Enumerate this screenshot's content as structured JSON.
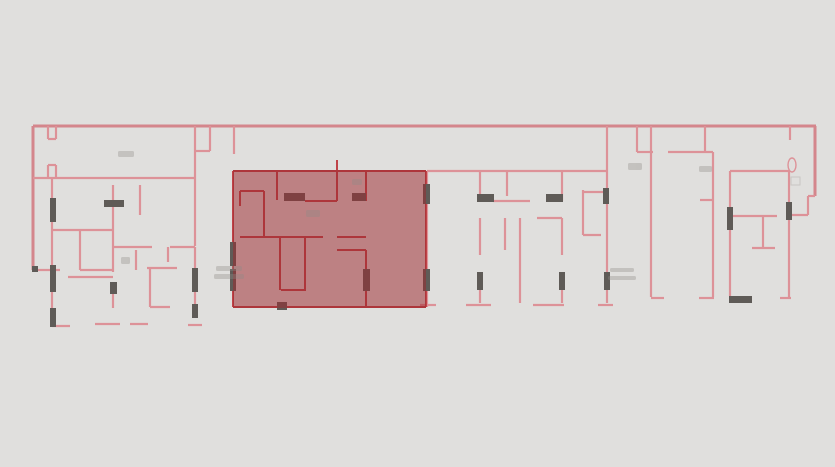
{
  "canvas": {
    "width": 835,
    "height": 467,
    "background": "#e0dfdd"
  },
  "palette": {
    "wall_pink": "#dd9298",
    "wall_pink_dark": "#d4868c",
    "wall_red": "#bf4348",
    "highlight_fill": "#9e2b30",
    "highlight_opacity": 0.52,
    "marker_dark": "#5f5b57",
    "fixture_faint": "#c9c6c2",
    "annotation": "#8f8b87"
  },
  "floorplan": {
    "outer_walls": [
      [
        33,
        126,
        816,
        126
      ],
      [
        815,
        126,
        815,
        196
      ],
      [
        33,
        126,
        33,
        270
      ]
    ],
    "pink_walls": [
      [
        808,
        196,
        815,
        196
      ],
      [
        808,
        196,
        808,
        215
      ],
      [
        789,
        215,
        808,
        215
      ],
      [
        33,
        270,
        60,
        270
      ],
      [
        48,
        126,
        48,
        139
      ],
      [
        56,
        126,
        56,
        139
      ],
      [
        48,
        139,
        56,
        139
      ],
      [
        48,
        165,
        48,
        178
      ],
      [
        56,
        165,
        56,
        178
      ],
      [
        48,
        165,
        56,
        165
      ],
      [
        33,
        178,
        195,
        178
      ],
      [
        195,
        126,
        195,
        246
      ],
      [
        210,
        126,
        210,
        151
      ],
      [
        195,
        151,
        210,
        151
      ],
      [
        234,
        126,
        234,
        154
      ],
      [
        52,
        178,
        52,
        198
      ],
      [
        52,
        222,
        52,
        265
      ],
      [
        52,
        292,
        52,
        308
      ],
      [
        52,
        326,
        70,
        326
      ],
      [
        80,
        230,
        80,
        270
      ],
      [
        52,
        230,
        113,
        230
      ],
      [
        80,
        270,
        113,
        270
      ],
      [
        113,
        185,
        113,
        272
      ],
      [
        113,
        294,
        113,
        308
      ],
      [
        95,
        324,
        120,
        324
      ],
      [
        68,
        277,
        113,
        277
      ],
      [
        140,
        185,
        140,
        215
      ],
      [
        113,
        247,
        152,
        247
      ],
      [
        170,
        247,
        195,
        247
      ],
      [
        168,
        247,
        168,
        262
      ],
      [
        136,
        250,
        136,
        270
      ],
      [
        130,
        324,
        148,
        324
      ],
      [
        147,
        268,
        177,
        268
      ],
      [
        150,
        268,
        150,
        307
      ],
      [
        150,
        307,
        170,
        307
      ],
      [
        195,
        247,
        195,
        268
      ],
      [
        195,
        292,
        195,
        304
      ],
      [
        188,
        325,
        202,
        325
      ],
      [
        427,
        171,
        608,
        171
      ],
      [
        427,
        171,
        427,
        307
      ],
      [
        480,
        171,
        480,
        201
      ],
      [
        493,
        201,
        530,
        201
      ],
      [
        507,
        171,
        507,
        196
      ],
      [
        562,
        171,
        562,
        201
      ],
      [
        480,
        218,
        480,
        255
      ],
      [
        505,
        218,
        505,
        250
      ],
      [
        537,
        218,
        562,
        218
      ],
      [
        562,
        218,
        562,
        255
      ],
      [
        520,
        218,
        520,
        303
      ],
      [
        480,
        290,
        480,
        303
      ],
      [
        466,
        305,
        491,
        305
      ],
      [
        562,
        290,
        562,
        303
      ],
      [
        533,
        305,
        564,
        305
      ],
      [
        583,
        190,
        583,
        235
      ],
      [
        583,
        192,
        606,
        192
      ],
      [
        583,
        235,
        601,
        235
      ],
      [
        607,
        126,
        607,
        272
      ],
      [
        607,
        290,
        607,
        303
      ],
      [
        598,
        305,
        613,
        305
      ],
      [
        420,
        305,
        436,
        305
      ],
      [
        637,
        126,
        637,
        152
      ],
      [
        651,
        126,
        651,
        152
      ],
      [
        637,
        152,
        653,
        152
      ],
      [
        668,
        152,
        713,
        152
      ],
      [
        651,
        152,
        651,
        297
      ],
      [
        651,
        298,
        664,
        298
      ],
      [
        713,
        152,
        713,
        297
      ],
      [
        699,
        298,
        714,
        298
      ],
      [
        700,
        200,
        713,
        200
      ],
      [
        705,
        126,
        705,
        152
      ],
      [
        730,
        171,
        790,
        171
      ],
      [
        730,
        171,
        730,
        207
      ],
      [
        730,
        230,
        730,
        296
      ],
      [
        733,
        216,
        777,
        216
      ],
      [
        763,
        216,
        763,
        247
      ],
      [
        752,
        248,
        775,
        248
      ],
      [
        789,
        171,
        789,
        202
      ],
      [
        789,
        220,
        789,
        297
      ],
      [
        780,
        298,
        791,
        298
      ],
      [
        790,
        126,
        790,
        140
      ]
    ],
    "red_walls": [
      [
        233,
        171,
        426,
        171
      ],
      [
        233,
        307,
        426,
        307
      ],
      [
        233,
        171,
        233,
        307
      ],
      [
        426,
        171,
        426,
        307
      ],
      [
        337,
        160,
        337,
        171
      ],
      [
        277,
        171,
        277,
        200
      ],
      [
        337,
        171,
        337,
        201
      ],
      [
        305,
        201,
        337,
        201
      ],
      [
        240,
        191,
        264,
        191
      ],
      [
        264,
        191,
        264,
        237
      ],
      [
        240,
        237,
        280,
        237
      ],
      [
        240,
        191,
        240,
        206
      ],
      [
        280,
        237,
        323,
        237
      ],
      [
        337,
        237,
        366,
        237
      ],
      [
        280,
        237,
        280,
        290
      ],
      [
        305,
        237,
        305,
        290
      ],
      [
        281,
        290,
        306,
        290
      ],
      [
        366,
        171,
        366,
        201
      ],
      [
        337,
        250,
        366,
        250
      ],
      [
        366,
        250,
        366,
        269
      ],
      [
        366,
        291,
        366,
        307
      ]
    ],
    "markers": [
      [
        50,
        198,
        6,
        24
      ],
      [
        104,
        200,
        20,
        7
      ],
      [
        32,
        266,
        6,
        6
      ],
      [
        50,
        265,
        6,
        27
      ],
      [
        50,
        308,
        6,
        19
      ],
      [
        110,
        282,
        7,
        12
      ],
      [
        192,
        268,
        6,
        24
      ],
      [
        192,
        304,
        6,
        14
      ],
      [
        284,
        193,
        21,
        8
      ],
      [
        352,
        193,
        14,
        8
      ],
      [
        230,
        242,
        6,
        24
      ],
      [
        230,
        269,
        6,
        22
      ],
      [
        423,
        184,
        7,
        20
      ],
      [
        423,
        269,
        7,
        22
      ],
      [
        363,
        269,
        7,
        22
      ],
      [
        277,
        302,
        10,
        8
      ],
      [
        477,
        194,
        17,
        8
      ],
      [
        546,
        194,
        17,
        8
      ],
      [
        477,
        272,
        6,
        18
      ],
      [
        559,
        272,
        6,
        18
      ],
      [
        604,
        272,
        6,
        18
      ],
      [
        603,
        188,
        6,
        16
      ],
      [
        727,
        207,
        6,
        23
      ],
      [
        786,
        202,
        6,
        18
      ],
      [
        729,
        296,
        23,
        7
      ]
    ],
    "ellipses": [
      [
        792,
        165,
        4,
        7
      ]
    ],
    "faint_rects": [
      [
        791,
        177,
        9,
        8
      ]
    ],
    "smudges": [
      [
        216,
        266,
        26,
        5
      ],
      [
        214,
        274,
        30,
        5
      ],
      [
        610,
        268,
        24,
        4
      ],
      [
        608,
        276,
        28,
        4
      ],
      [
        118,
        151,
        16,
        6
      ],
      [
        628,
        163,
        14,
        7
      ],
      [
        699,
        166,
        13,
        6
      ],
      [
        306,
        210,
        14,
        7
      ],
      [
        121,
        257,
        9,
        7
      ],
      [
        352,
        179,
        10,
        6
      ]
    ],
    "highlight": {
      "x": 233,
      "y": 170,
      "width": 193,
      "height": 138
    }
  }
}
